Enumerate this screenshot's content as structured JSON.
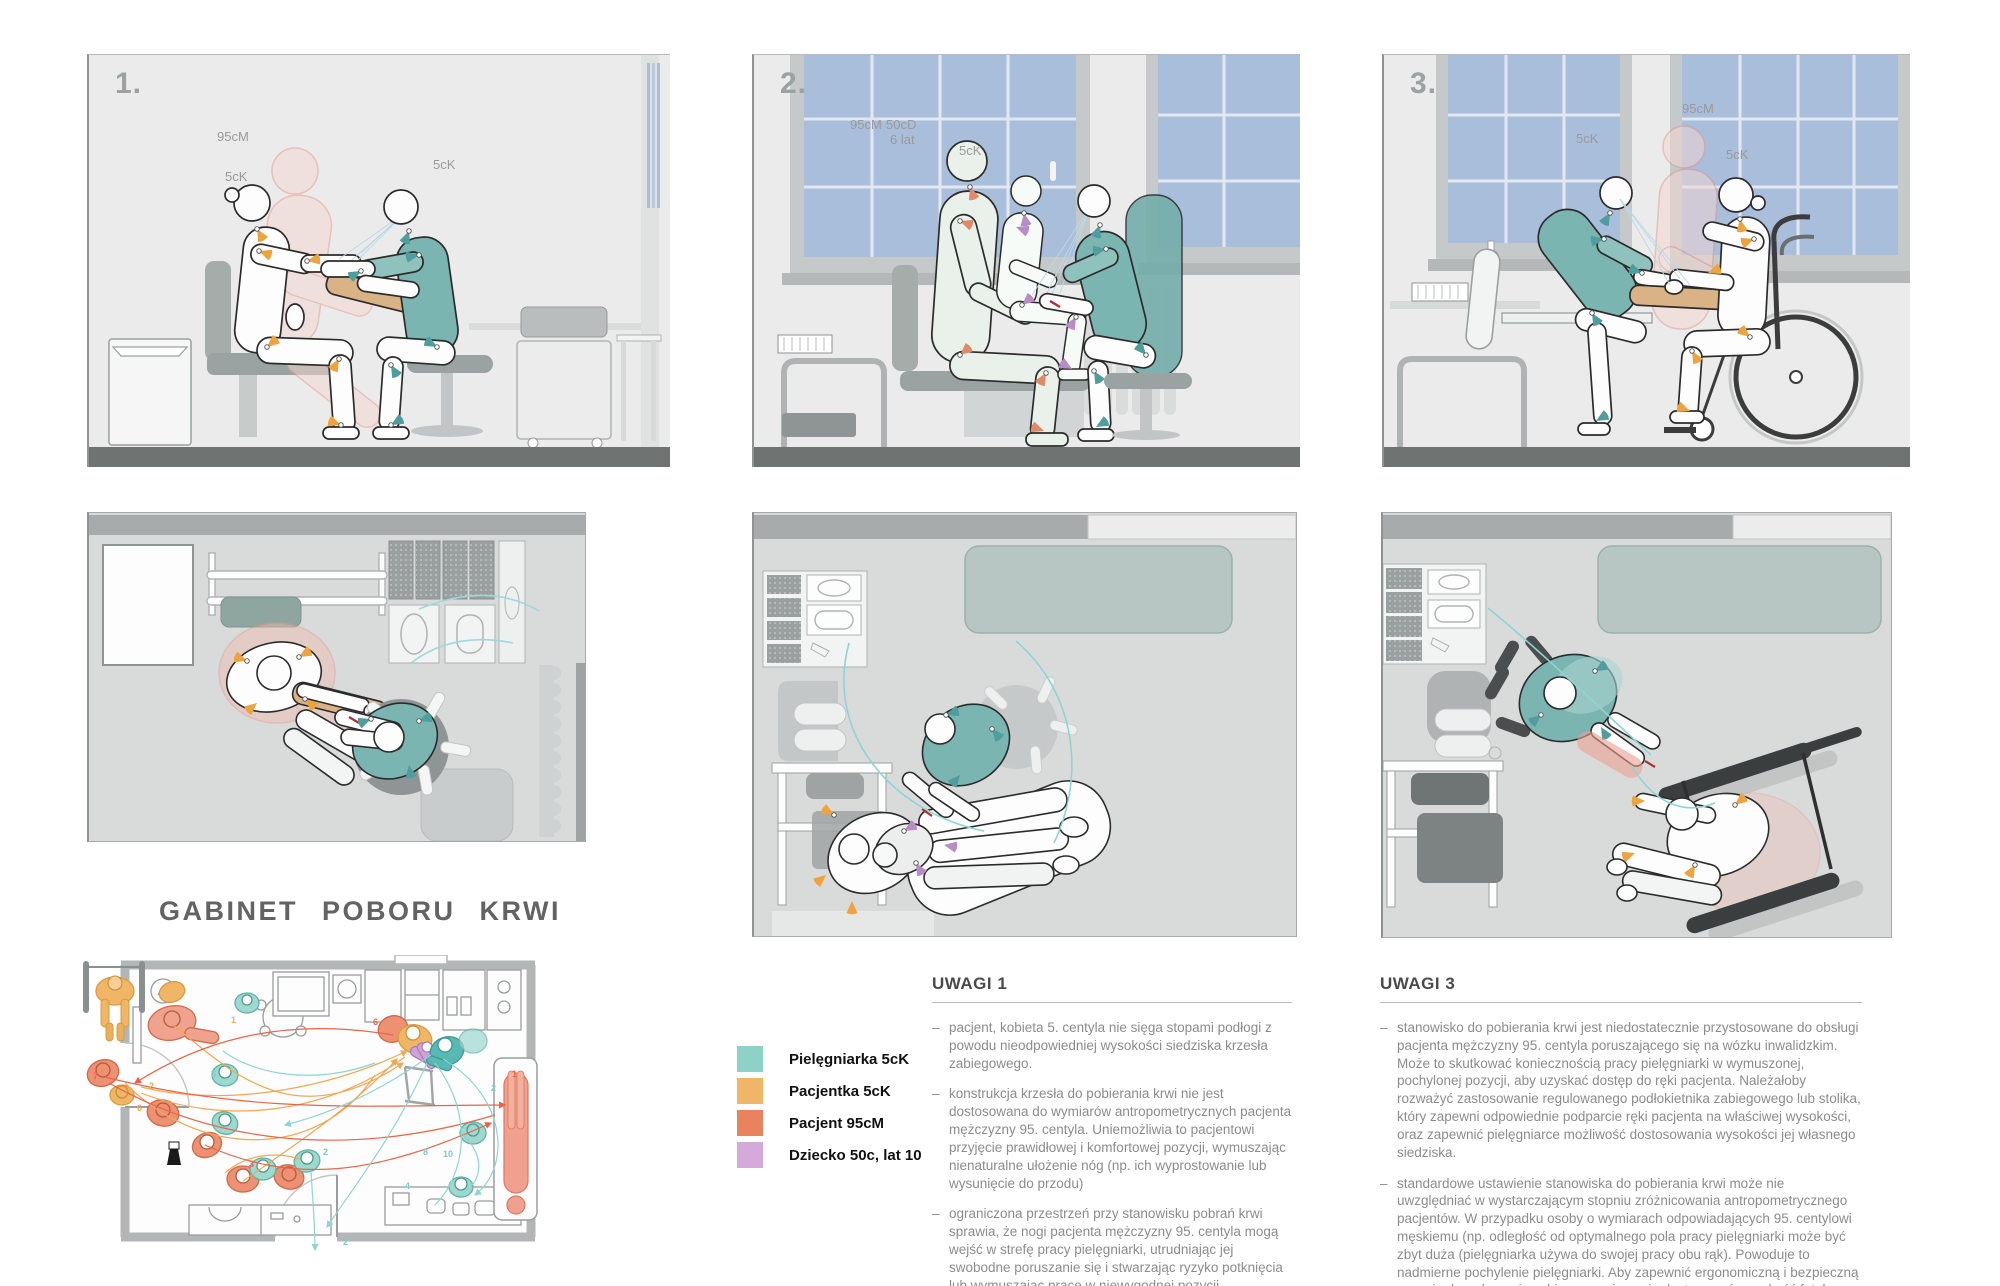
{
  "poster": {
    "title": "GABINET POBORU KRWI"
  },
  "side_panels": [
    {
      "number": "1.",
      "labels": [
        {
          "text": "95cM"
        },
        {
          "text": "5cK"
        },
        {
          "text": "5cK"
        }
      ]
    },
    {
      "number": "2.",
      "labels": [
        {
          "text": "95cM"
        },
        {
          "text": "50cD"
        },
        {
          "text": "6 lat"
        },
        {
          "text": "5cK"
        }
      ]
    },
    {
      "number": "3.",
      "labels": [
        {
          "text": "5cK"
        },
        {
          "text": "95cM"
        },
        {
          "text": "5cK"
        }
      ]
    }
  ],
  "legend": {
    "items": [
      {
        "label": "Pielęgniarka 5cK",
        "color": "#8ed1c6"
      },
      {
        "label": "Pacjentka 5cK",
        "color": "#f0b566"
      },
      {
        "label": "Pacjent 95cM",
        "color": "#e8825f"
      },
      {
        "label": "Dziecko 50c, lat 10",
        "color": "#d5aadb"
      }
    ]
  },
  "notes_1": {
    "heading": "UWAGI 1",
    "bullet_dash": "–",
    "bullets": [
      "pacjent, kobieta 5. centyla nie sięga stopami podłogi z powodu nieodpowiedniej wysokości siedziska krzesła zabiegowego.",
      "konstrukcja krzesła do pobierania krwi nie jest dostosowana do wymiarów antropometrycznych pacjenta mężczyzny 95. centyla. Uniemożliwia to pacjentowi przyjęcie prawidłowej i komfortowej pozycji, wymuszając nienaturalne ułożenie nóg (np. ich wyprostowanie lub wysunięcie do przodu)",
      "ograniczona przestrzeń przy stanowisku pobrań krwi sprawia, że nogi pacjenta mężczyzny 95. centyla mogą wejść w strefę pracy pielęgniarki, utrudniając jej swobodne poruszanie się i stwarzając ryzyko potknięcia lub wymuszając pracę w niewygodnej pozycji."
    ]
  },
  "notes_3": {
    "heading": "UWAGI 3",
    "bullet_dash": "–",
    "bullets": [
      "stanowisko do pobierania krwi jest niedostatecznie przystosowane do obsługi pacjenta mężczyzny 95. centyla poruszającego się na wózku inwalidzkim. Może to skutkować koniecznością pracy pielęgniarki w wymuszonej, pochylonej pozycji, aby uzyskać dostęp do ręki pacjenta. Należałoby rozważyć zastosowanie regulowanego podłokietnika zabiegowego lub stolika, który zapewni odpowiednie podparcie ręki pacjenta na właściwej wysokości, oraz zapewnić pielęgniarce możliwość dostosowania wysokości jej własnego siedziska.",
      "standardowe ustawienie stanowiska do pobierania krwi może nie uwzględniać w wystarczającym stopniu zróżnicowania antropometrycznego pacjentów. W przypadku osoby o wymiarach odpowiadających 95. centylowi męskiemu (np. odległość od optymalnego pola pracy pielęgniarki może być zbyt duża (pielęgniarka używa do swojej pracy obu rąk). Powoduje to nadmierne pochylenie pielęgniarki. Aby zapewnić ergonomiczną i bezpieczną pozycję do wykonania zabiegu, powinno się dostosować wysokość fotela zabiegowego (jeśli pacjent z niego korzysta)."
    ]
  },
  "plan": {
    "numbers": [
      {
        "t": "7",
        "c": "#e8654a"
      },
      {
        "t": "6",
        "c": "#f0a852"
      },
      {
        "t": "2",
        "c": "#f0a852"
      },
      {
        "t": "1",
        "c": "#f0a852"
      },
      {
        "t": "5",
        "c": "#7ccaca"
      },
      {
        "t": "3",
        "c": "#e8654a"
      },
      {
        "t": "2",
        "c": "#7ccaca"
      },
      {
        "t": "6",
        "c": "#e8654a"
      },
      {
        "t": "8",
        "c": "#7ccaca"
      },
      {
        "t": "10",
        "c": "#7ccaca"
      },
      {
        "t": "4",
        "c": "#7ccaca"
      },
      {
        "t": "2",
        "c": "#7ccaca"
      },
      {
        "t": "1",
        "c": "#e8654a"
      },
      {
        "t": "2",
        "c": "#7ccaca"
      }
    ]
  }
}
